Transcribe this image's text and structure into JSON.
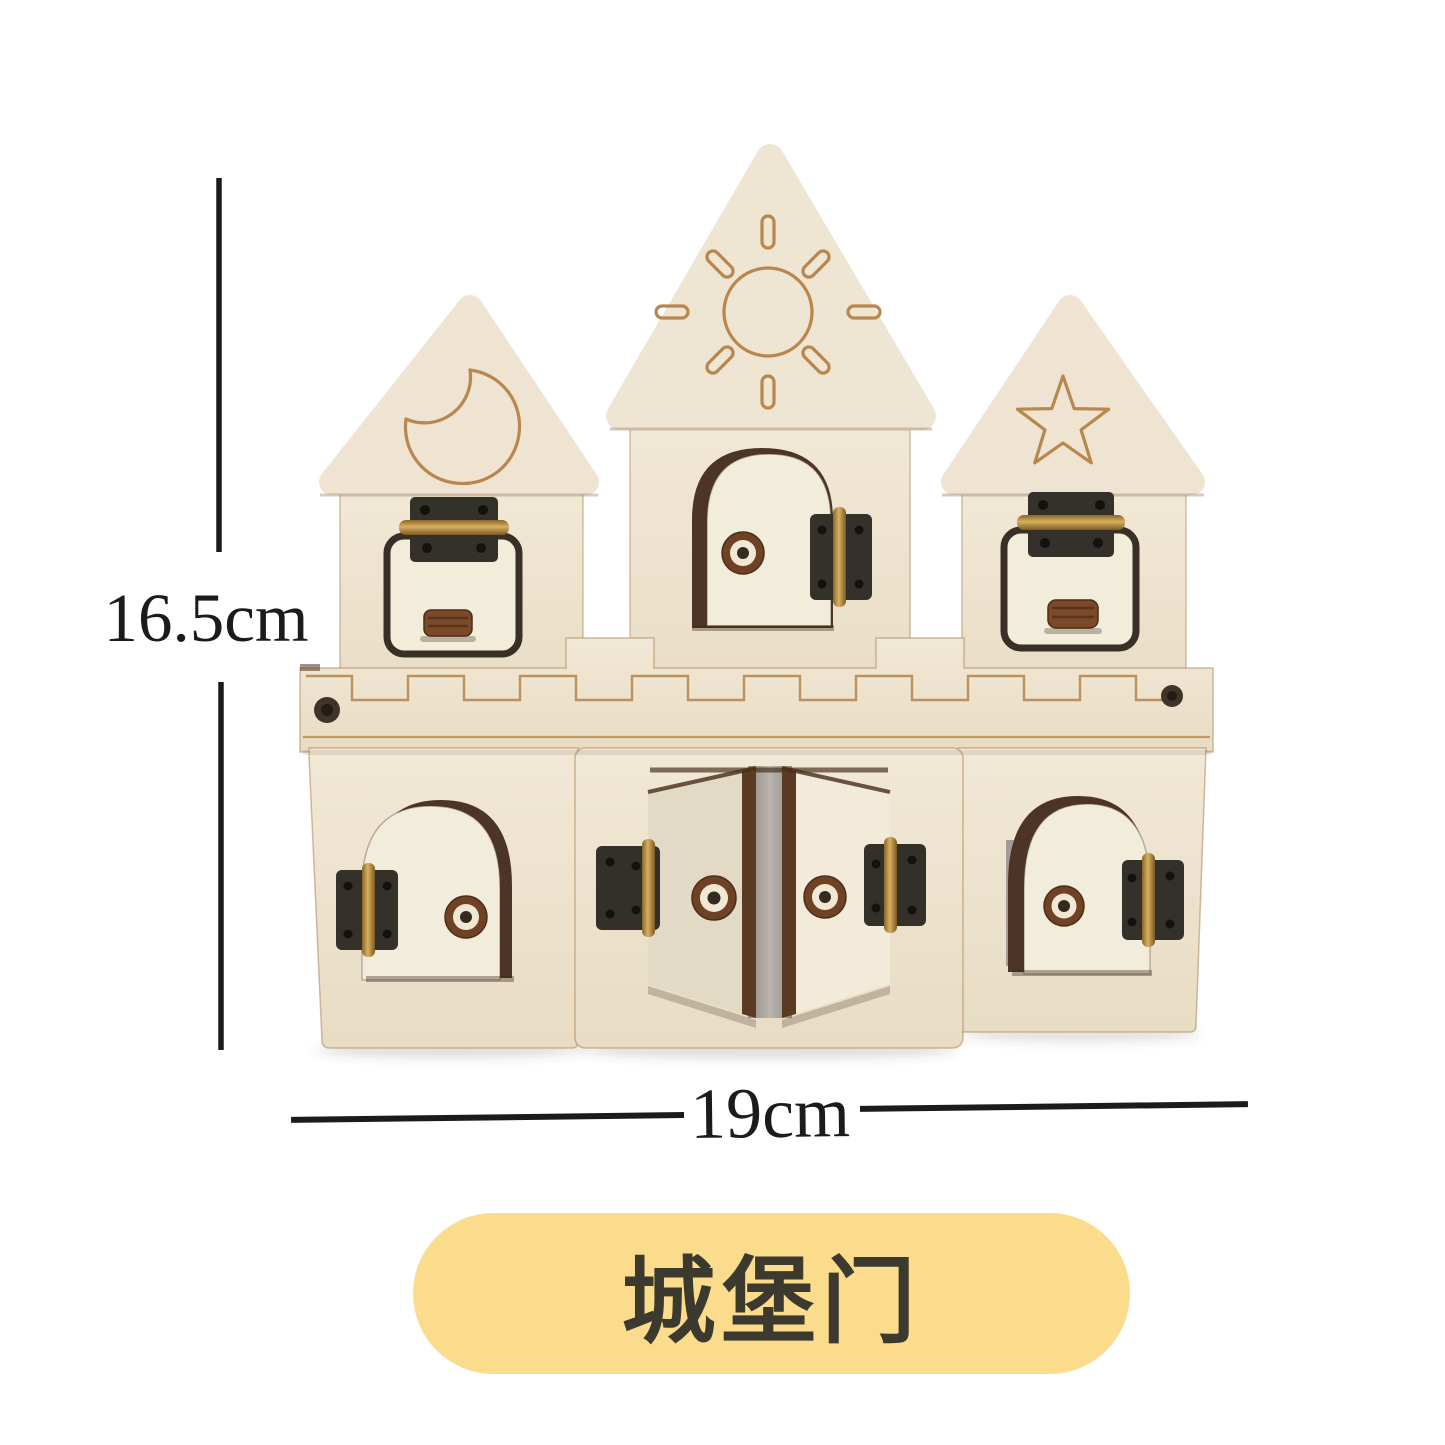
{
  "annotations": {
    "height_label": "16.5cm",
    "width_label": "19cm"
  },
  "caption": {
    "label": "城堡门"
  },
  "engraving_icons": [
    "moon",
    "sun",
    "star"
  ],
  "palette": {
    "background": "#ffffff",
    "wood": "#ece1cc",
    "wood_light": "#f2ecdb",
    "engraving_line": "#b8874d",
    "door_edge_dark": "#4c3526",
    "hinge_metal": "#34302a",
    "hinge_pin_brass": "#a98336",
    "knob_brown": "#6f4226",
    "knob_cream": "#f0e8d5",
    "doorway_gray": "#a19d96",
    "caption_pill_bg": "#fadc8c",
    "caption_text": "#3c392f",
    "dimension_line": "#1b1b1b"
  }
}
